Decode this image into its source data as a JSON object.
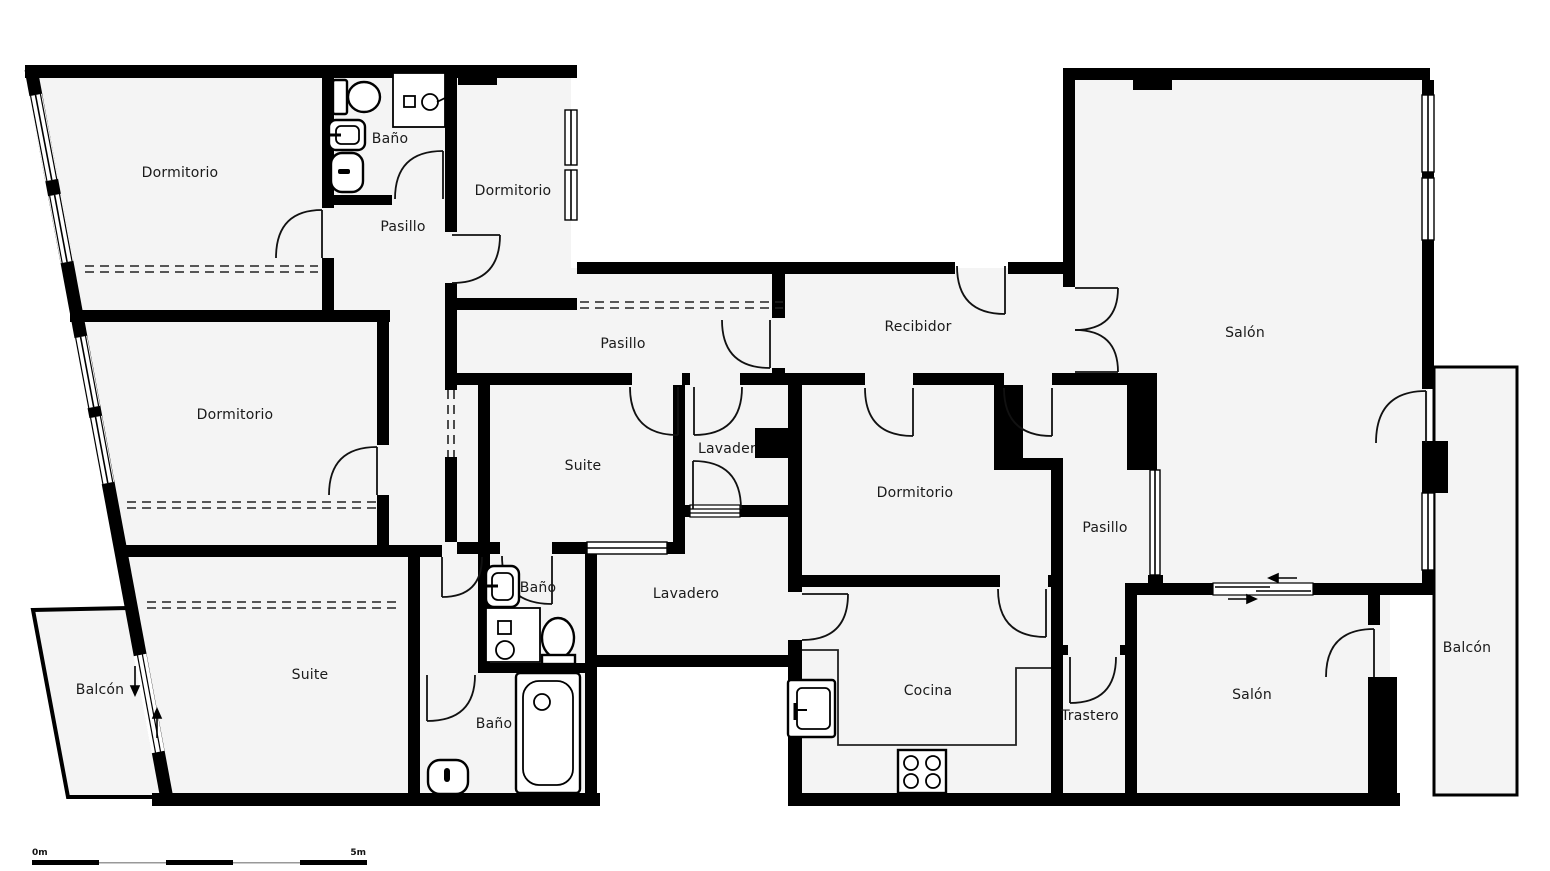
{
  "floorplan": {
    "colors": {
      "wall": "#000000",
      "floor": "#f4f4f4",
      "label": "#1a1a1a"
    },
    "rooms": [
      {
        "id": "dormitorio-top-left",
        "label": "Dormitorio"
      },
      {
        "id": "bano-top",
        "label": "Baño"
      },
      {
        "id": "pasillo-top-left",
        "label": "Pasillo"
      },
      {
        "id": "dormitorio-top-center",
        "label": "Dormitorio"
      },
      {
        "id": "pasillo-main",
        "label": "Pasillo"
      },
      {
        "id": "recibidor",
        "label": "Recibidor"
      },
      {
        "id": "salon-main",
        "label": "Salón"
      },
      {
        "id": "dormitorio-left",
        "label": "Dormitorio"
      },
      {
        "id": "suite-middle",
        "label": "Suite"
      },
      {
        "id": "lavadero-small",
        "label": "Lavadero"
      },
      {
        "id": "dormitorio-center",
        "label": "Dormitorio"
      },
      {
        "id": "pasillo-right",
        "label": "Pasillo"
      },
      {
        "id": "bano-middle",
        "label": "Baño"
      },
      {
        "id": "lavadero",
        "label": "Lavadero"
      },
      {
        "id": "suite-bottom",
        "label": "Suite"
      },
      {
        "id": "balcon-bottom-left",
        "label": "Balcón"
      },
      {
        "id": "bano-bottom",
        "label": "Baño"
      },
      {
        "id": "cocina",
        "label": "Cocina"
      },
      {
        "id": "trastero",
        "label": "Trastero"
      },
      {
        "id": "salon-bottom",
        "label": "Salón"
      },
      {
        "id": "balcon-right",
        "label": "Balcón"
      }
    ],
    "fixtures": [
      "toilet",
      "shower",
      "sink",
      "bidet",
      "bathtub",
      "kitchen-sink",
      "stove",
      "counter"
    ],
    "scale_bar": {
      "start_label": "0m",
      "end_label": "5m"
    }
  }
}
